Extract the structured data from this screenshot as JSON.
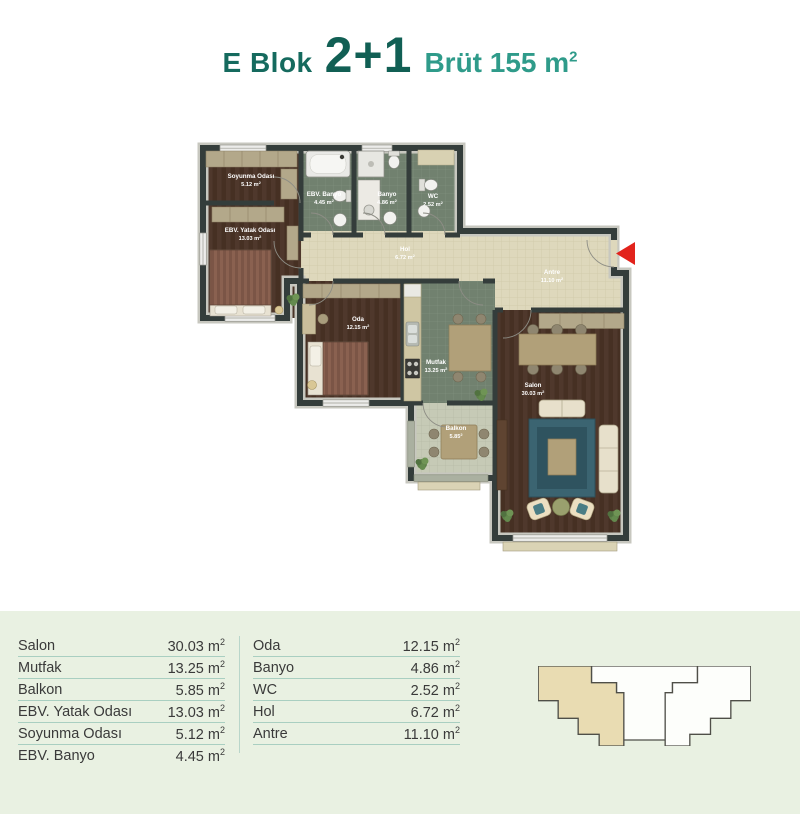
{
  "title": {
    "block": "E Blok",
    "unit_type": "2+1",
    "gross_text": "Brüt 155 m",
    "gross_sup": "2"
  },
  "units": {
    "base": " m",
    "sup": "2"
  },
  "plan": {
    "rooms": {
      "soyunma_odasi": {
        "name": "Soyunma Odası",
        "area": "5.12"
      },
      "ebv_yatak_odasi": {
        "name": "EBV. Yatak Odası",
        "area": "13.03"
      },
      "ebv_banyo": {
        "name": "EBV. Banyo",
        "area": "4.45"
      },
      "banyo": {
        "name": "Banyo",
        "area": "4.86"
      },
      "wc": {
        "name": "WC",
        "area": "2.52"
      },
      "hol": {
        "name": "Hol",
        "area": "6.72"
      },
      "antre": {
        "name": "Antre",
        "area": "11.10"
      },
      "oda": {
        "name": "Oda",
        "area": "12.15"
      },
      "mutfak": {
        "name": "Mutfak",
        "area": "13.25"
      },
      "balkon": {
        "name": "Balkon",
        "area": "5.85"
      },
      "salon": {
        "name": "Salon",
        "area": "30.03"
      }
    }
  },
  "tables": {
    "left": [
      {
        "label": "Salon",
        "value": "30.03"
      },
      {
        "label": "Mutfak",
        "value": "13.25"
      },
      {
        "label": "Balkon",
        "value": "5.85"
      },
      {
        "label": "EBV. Yatak Odası",
        "value": "13.03"
      },
      {
        "label": "Soyunma Odası",
        "value": "5.12"
      },
      {
        "label": "EBV. Banyo",
        "value": "4.45"
      }
    ],
    "right": [
      {
        "label": "Oda",
        "value": "12.15"
      },
      {
        "label": "Banyo",
        "value": "4.86"
      },
      {
        "label": "WC",
        "value": "2.52"
      },
      {
        "label": "Hol",
        "value": "6.72"
      },
      {
        "label": "Antre",
        "value": "11.10"
      }
    ]
  },
  "colors": {
    "title_dark_teal": "#156a5e",
    "title_light_teal": "#2f9b8a",
    "band_background": "#e9f1e2",
    "table_rule": "#a9cfc1",
    "wall": "#343d3b",
    "footprint_highlight": "#e9dcb2",
    "entrance_arrow": "#e2231c"
  }
}
